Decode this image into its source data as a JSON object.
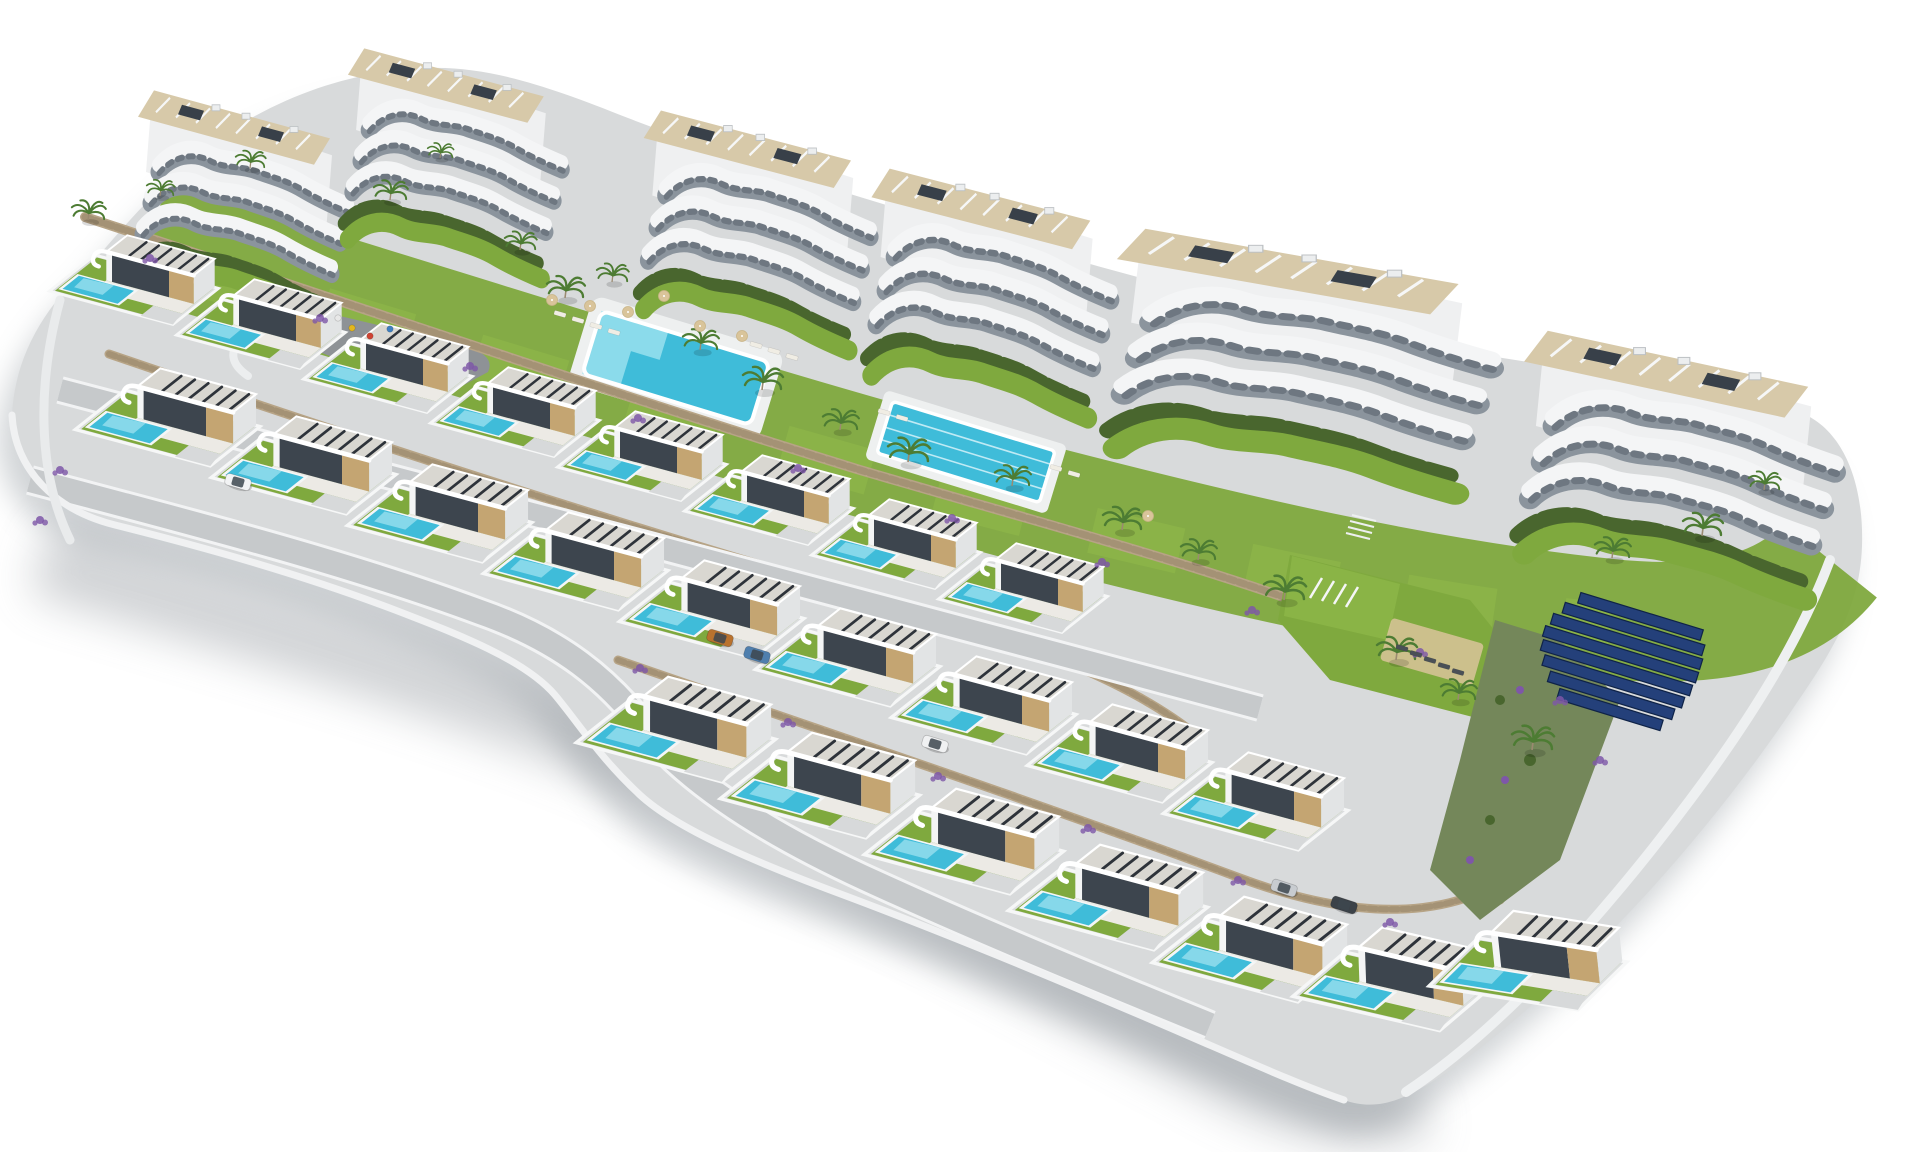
{
  "meta": {
    "kind": "architectural-aerial-render",
    "subject": "hillside residential development with apartment blocks, terraced villas with private pools, communal pools and gardens on a white cut-out background"
  },
  "palette": {
    "bg": "#ffffff",
    "concrete": "#d8dadb",
    "concrete2": "#cfd2d4",
    "street": "#c6c9cb",
    "curb": "#f2f3f4",
    "lawn": "#7fa93e",
    "lawn2": "#8fb94a",
    "hedge": "#49662e",
    "scrub": "#74875a",
    "wall": "#b7a486",
    "walljoint": "#9b8a6e",
    "pool": "#3fbcd9",
    "poollight": "#9fe2ef",
    "deck": "#d7c9a9",
    "roof": "#d9d7d1",
    "slat": "#2e333a",
    "beige": "#c4a572",
    "glass": "#3d454e",
    "band": "#f4f5f6",
    "bandin": "#8b949d",
    "purple": "#7e57a8",
    "palm": "#4d7c33",
    "tan": "#d9c49a",
    "shadow": "#99a0a6",
    "plaza": "#8e9296",
    "solar": "#24407a",
    "solarline": "#0f2347"
  },
  "scene": {
    "features": [
      "apartment buildings",
      "detached villas with private pools",
      "communal swimming pool",
      "lap pool with lanes",
      "children playground",
      "solar panel array",
      "landscaped gardens with palms",
      "stone retaining walls",
      "internal streets with parked cars"
    ],
    "apartments": [
      {
        "x": 142,
        "y": 88,
        "sx": 1.0,
        "sy": 1.2
      },
      {
        "x": 352,
        "y": 46,
        "sx": 1.02,
        "sy": 1.2
      },
      {
        "x": 648,
        "y": 108,
        "sx": 1.08,
        "sy": 1.25
      },
      {
        "x": 876,
        "y": 166,
        "sx": 1.14,
        "sy": 1.3
      },
      {
        "x": 1124,
        "y": 226,
        "sx": 1.78,
        "sy": 1.38
      },
      {
        "x": 1530,
        "y": 328,
        "sx": 1.48,
        "sy": 1.4
      }
    ],
    "villas": {
      "rows": [
        {
          "name": "row-a",
          "items": [
            {
              "x": 95,
              "y": 255,
              "s": 0.95
            },
            {
              "x": 222,
              "y": 299,
              "s": 0.95
            },
            {
              "x": 349,
              "y": 343,
              "s": 0.95
            },
            {
              "x": 476,
              "y": 387,
              "s": 0.95
            },
            {
              "x": 603,
              "y": 431,
              "s": 0.95
            },
            {
              "x": 730,
              "y": 475,
              "s": 0.95
            },
            {
              "x": 857,
              "y": 519,
              "s": 0.95
            },
            {
              "x": 984,
              "y": 563,
              "s": 0.95
            }
          ]
        },
        {
          "name": "row-b",
          "items": [
            {
              "x": 125,
              "y": 390,
              "s": 1.04
            },
            {
              "x": 261,
              "y": 438,
              "s": 1.04
            },
            {
              "x": 397,
              "y": 486,
              "s": 1.04
            },
            {
              "x": 533,
              "y": 534,
              "s": 1.04
            },
            {
              "x": 669,
              "y": 582,
              "s": 1.04
            },
            {
              "x": 805,
              "y": 630,
              "s": 1.04
            },
            {
              "x": 941,
              "y": 678,
              "s": 1.04
            },
            {
              "x": 1077,
              "y": 726,
              "s": 1.04
            },
            {
              "x": 1213,
              "y": 774,
              "s": 1.04
            }
          ]
        },
        {
          "name": "row-c",
          "items": [
            {
              "x": 630,
              "y": 700,
              "s": 1.12
            },
            {
              "x": 774,
              "y": 756,
              "s": 1.12
            },
            {
              "x": 918,
              "y": 812,
              "s": 1.12
            },
            {
              "x": 1062,
              "y": 868,
              "s": 1.12
            },
            {
              "x": 1206,
              "y": 920,
              "s": 1.12
            },
            {
              "x": 1345,
              "y": 952,
              "s": 1.12,
              "r": -2
            },
            {
              "x": 1478,
              "y": 938,
              "s": 1.12,
              "r": -6
            }
          ]
        }
      ]
    },
    "palms": [
      {
        "x": 88,
        "y": 220,
        "s": 0.85
      },
      {
        "x": 160,
        "y": 196,
        "s": 0.7
      },
      {
        "x": 250,
        "y": 168,
        "s": 0.75
      },
      {
        "x": 390,
        "y": 200,
        "s": 0.85
      },
      {
        "x": 440,
        "y": 158,
        "s": 0.65
      },
      {
        "x": 520,
        "y": 250,
        "s": 0.8
      },
      {
        "x": 565,
        "y": 298,
        "s": 0.95
      },
      {
        "x": 612,
        "y": 282,
        "s": 0.8
      },
      {
        "x": 700,
        "y": 350,
        "s": 0.9
      },
      {
        "x": 762,
        "y": 390,
        "s": 1.0
      },
      {
        "x": 840,
        "y": 430,
        "s": 0.9
      },
      {
        "x": 908,
        "y": 462,
        "s": 1.05
      },
      {
        "x": 1012,
        "y": 486,
        "s": 0.9
      },
      {
        "x": 1122,
        "y": 530,
        "s": 1.0
      },
      {
        "x": 1198,
        "y": 560,
        "s": 0.9
      },
      {
        "x": 1284,
        "y": 600,
        "s": 1.05
      },
      {
        "x": 1396,
        "y": 660,
        "s": 1.0
      },
      {
        "x": 1458,
        "y": 700,
        "s": 0.9
      },
      {
        "x": 1532,
        "y": 750,
        "s": 1.05
      },
      {
        "x": 1612,
        "y": 558,
        "s": 0.9
      },
      {
        "x": 1702,
        "y": 536,
        "s": 1.0
      },
      {
        "x": 1764,
        "y": 490,
        "s": 0.8
      }
    ],
    "flowers": [
      {
        "x": 150,
        "y": 258
      },
      {
        "x": 320,
        "y": 318
      },
      {
        "x": 470,
        "y": 366
      },
      {
        "x": 638,
        "y": 418
      },
      {
        "x": 798,
        "y": 468
      },
      {
        "x": 952,
        "y": 518
      },
      {
        "x": 1102,
        "y": 562
      },
      {
        "x": 1252,
        "y": 610
      },
      {
        "x": 1420,
        "y": 652
      },
      {
        "x": 640,
        "y": 668
      },
      {
        "x": 788,
        "y": 722
      },
      {
        "x": 938,
        "y": 776
      },
      {
        "x": 1088,
        "y": 828
      },
      {
        "x": 1238,
        "y": 880
      },
      {
        "x": 1390,
        "y": 922
      },
      {
        "x": 60,
        "y": 470
      },
      {
        "x": 40,
        "y": 520
      },
      {
        "x": 1560,
        "y": 700
      },
      {
        "x": 1600,
        "y": 760
      }
    ],
    "cars": [
      {
        "x": 238,
        "y": 482,
        "r": 16,
        "c": "#f2f3f4"
      },
      {
        "x": 720,
        "y": 638,
        "r": 17,
        "c": "#b9722e"
      },
      {
        "x": 757,
        "y": 655,
        "r": 17,
        "c": "#4f7fae"
      },
      {
        "x": 935,
        "y": 744,
        "r": 17,
        "c": "#f0f1f2"
      },
      {
        "x": 1284,
        "y": 888,
        "r": 18,
        "c": "#c8ccd0"
      },
      {
        "x": 1344,
        "y": 905,
        "r": 18,
        "c": "#3c4248"
      }
    ],
    "loungers": [
      {
        "x": 560,
        "y": 314,
        "r": 16,
        "c": "#f0ede4"
      },
      {
        "x": 578,
        "y": 320,
        "r": 16,
        "c": "#f0ede4"
      },
      {
        "x": 596,
        "y": 326,
        "r": 16,
        "c": "#f0ede4"
      },
      {
        "x": 614,
        "y": 332,
        "r": 16,
        "c": "#f0ede4"
      },
      {
        "x": 756,
        "y": 345,
        "r": 16,
        "c": "#f0ede4"
      },
      {
        "x": 774,
        "y": 351,
        "r": 16,
        "c": "#f0ede4"
      },
      {
        "x": 792,
        "y": 357,
        "r": 16,
        "c": "#f0ede4"
      },
      {
        "x": 884,
        "y": 412,
        "r": 16,
        "c": "#f0ede4"
      },
      {
        "x": 902,
        "y": 418,
        "r": 16,
        "c": "#f0ede4"
      },
      {
        "x": 1056,
        "y": 468,
        "r": 16,
        "c": "#f0ede4"
      },
      {
        "x": 1074,
        "y": 474,
        "r": 16,
        "c": "#f0ede4"
      },
      {
        "x": 1402,
        "y": 648,
        "r": 16,
        "c": "#4a5056"
      },
      {
        "x": 1416,
        "y": 654,
        "r": 16,
        "c": "#4a5056"
      },
      {
        "x": 1430,
        "y": 660,
        "r": 16,
        "c": "#4a5056"
      },
      {
        "x": 1444,
        "y": 666,
        "r": 16,
        "c": "#4a5056"
      },
      {
        "x": 1458,
        "y": 672,
        "r": 16,
        "c": "#4a5056"
      }
    ],
    "parasols": [
      {
        "x": 552,
        "y": 300
      },
      {
        "x": 590,
        "y": 306
      },
      {
        "x": 628,
        "y": 312
      },
      {
        "x": 700,
        "y": 326
      },
      {
        "x": 742,
        "y": 336
      },
      {
        "x": 664,
        "y": 296
      },
      {
        "x": 1148,
        "y": 516
      }
    ],
    "toys": [
      {
        "x": 352,
        "y": 328,
        "c": "#e3b71e"
      },
      {
        "x": 370,
        "y": 336,
        "c": "#cf4332"
      },
      {
        "x": 390,
        "y": 329,
        "c": "#3f7fbf"
      },
      {
        "x": 338,
        "y": 318,
        "c": "#e8e8e8"
      }
    ]
  }
}
